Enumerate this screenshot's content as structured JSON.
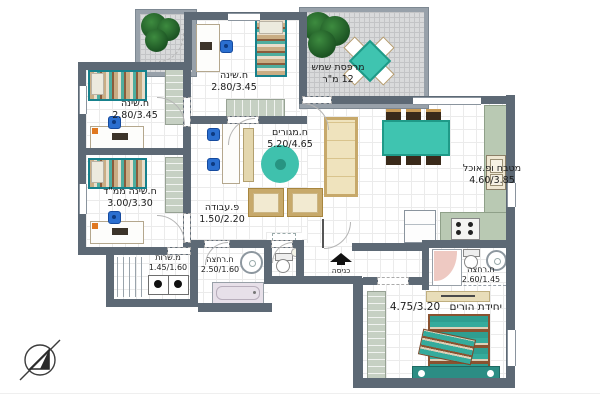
{
  "rooms": {
    "bedroom_top": {
      "name": "ח.שינה",
      "dims": "2.80/3.45"
    },
    "bedroom_left": {
      "name": "ח.שינה",
      "dims": "2.80/3.45"
    },
    "bedroom_mamad": {
      "name": "ח.שינה ממ\"ד",
      "dims": "3.00/3.30"
    },
    "living": {
      "name": "ח.מגורים",
      "dims": "5.20/4.65"
    },
    "work": {
      "name": "פ.עבודה",
      "dims": "1.50/2.20"
    },
    "kitchen": {
      "name": "מטבח ופ.אוכל",
      "dims": "4.60/3.85"
    },
    "balcony": {
      "name": "מרפסת שמש",
      "dims": "12 מ\"ר"
    },
    "service": {
      "name": "מ.שרות",
      "dims": "1.45/1.60"
    },
    "bath": {
      "name": "ח.רחצה",
      "dims": "2.50/1.60"
    },
    "master_bath": {
      "name": "ח.רחצה",
      "dims": "2.60/1.45"
    },
    "master": {
      "name": "יחידת הורים",
      "dims": "4.75/3.20"
    },
    "entrance": {
      "name": "כניסה"
    }
  },
  "colors": {
    "wall": "#5d6975",
    "accent_teal": "#3fc4b0",
    "sofa_beige": "#efe3bd",
    "closet_sage": "#c6d0c3",
    "counter_sage": "#b9c9b3",
    "tree_green": "#1c5423"
  },
  "icons": {
    "north_compass": "circle-with-north-arrow",
    "entrance_arrow": "solid-up-arrow"
  }
}
